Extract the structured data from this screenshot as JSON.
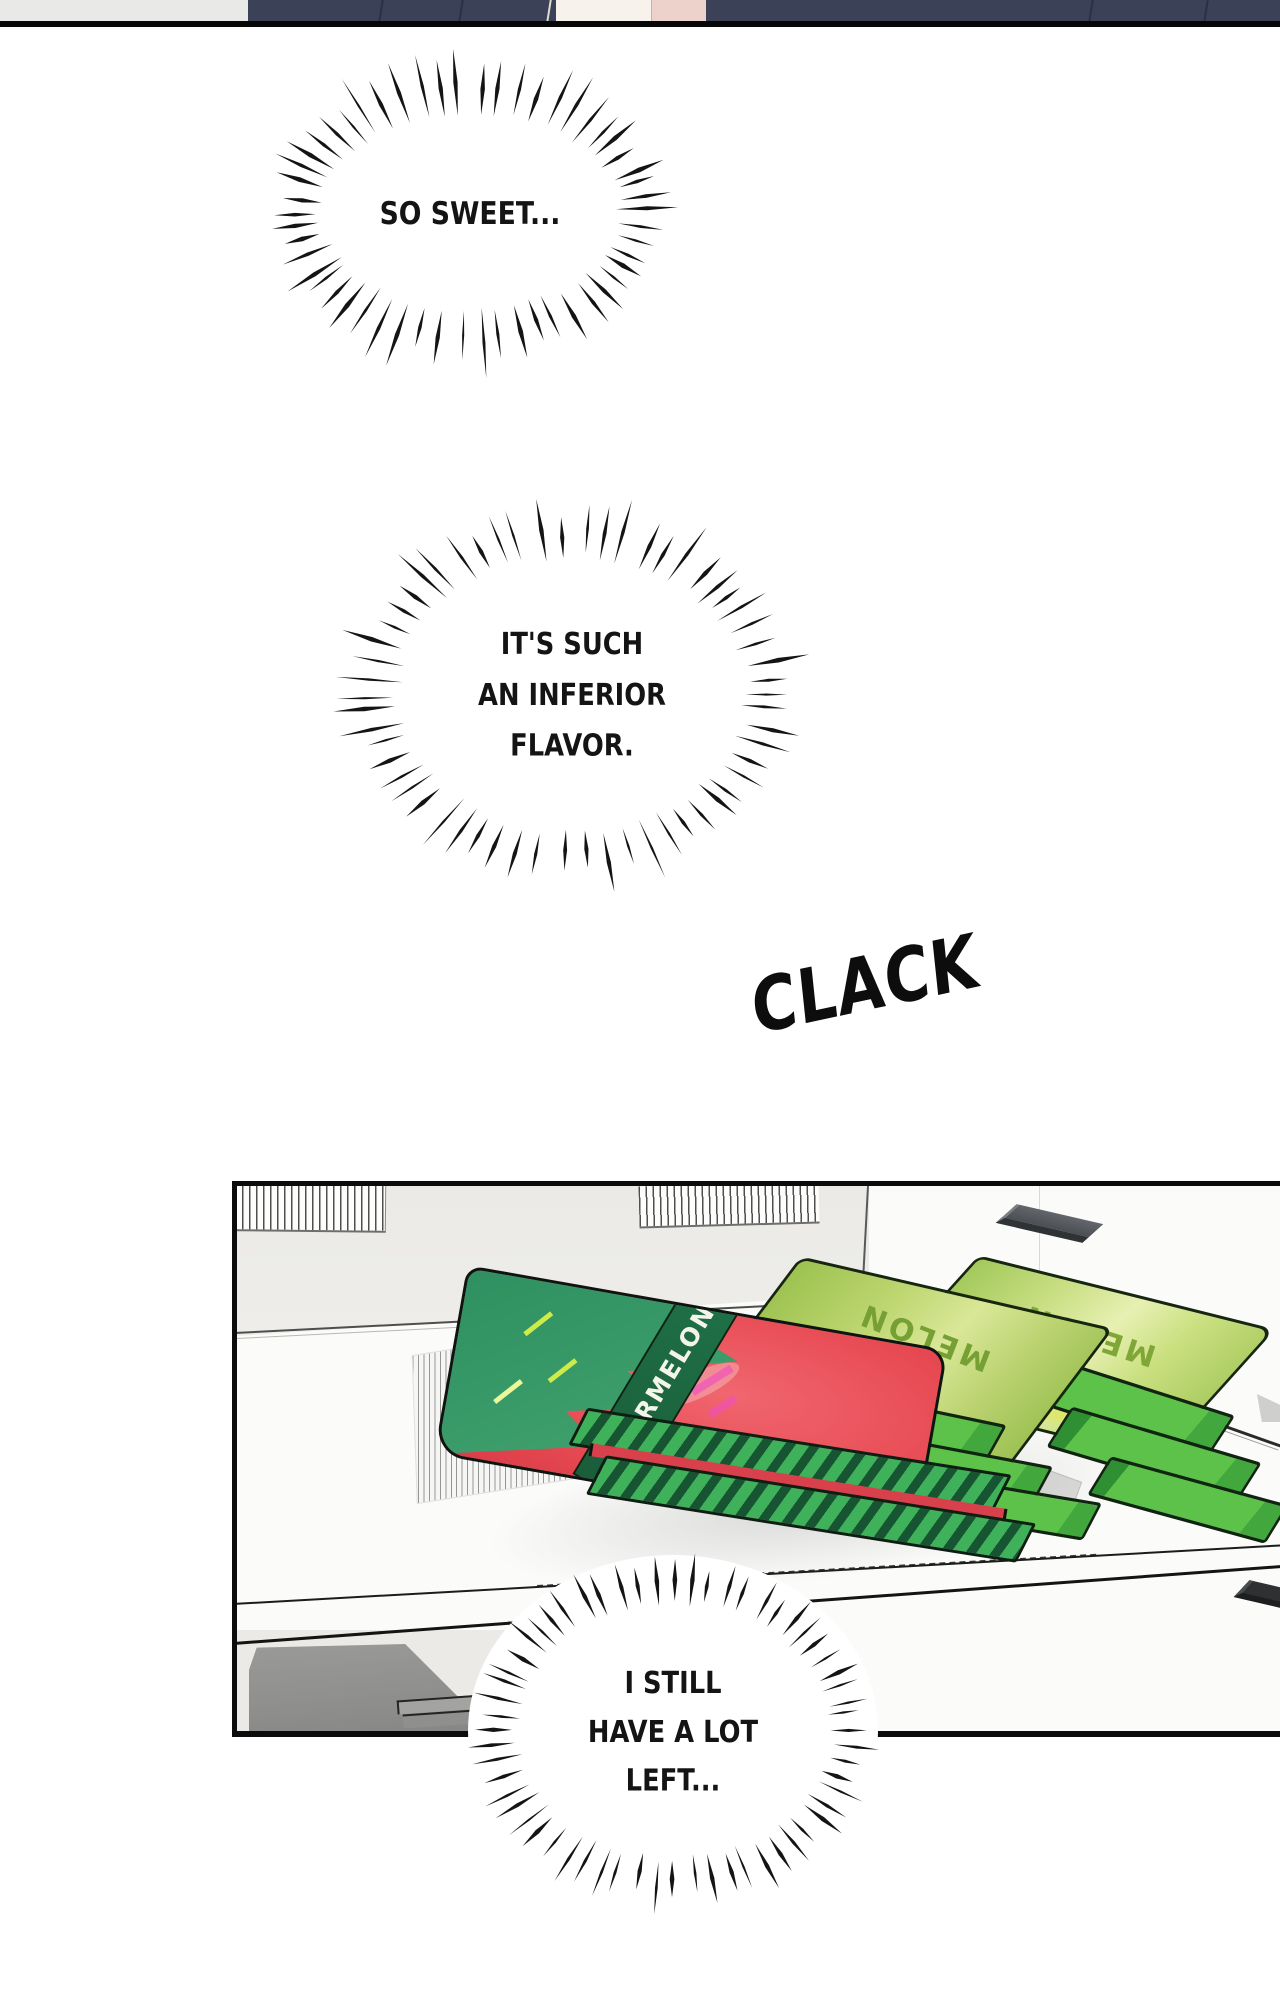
{
  "bubbles": [
    {
      "lines": [
        "SO SWEET..."
      ]
    },
    {
      "lines": [
        "IT'S SUCH",
        "AN INFERIOR",
        "FLAVOR."
      ]
    },
    {
      "lines": [
        "I STILL",
        "HAVE A LOT",
        "LEFT..."
      ]
    }
  ],
  "sfx": {
    "clack": "CLACK"
  },
  "packages": {
    "watermelon": "WATERMELON!",
    "melon_back": "MELON",
    "melon_front": "MELON"
  },
  "colors": {
    "panel_border": "#0c0c0c",
    "freezer_wall": "#ebeae7",
    "freezer_floor": "#fbfbfa",
    "watermelon_red": "#e84b54",
    "watermelon_rind": "#3fa06d",
    "banner_green": "#1f7046",
    "crimp_light_green": "#3fb15b",
    "crimp_dark_green": "#175431",
    "melon_pack_green": "#c8de82",
    "melon_text_green": "#7fa738",
    "tab_green": "#5cc24a",
    "handle_gray": "#4b4f53",
    "drawer_gray": "#8e8e8c",
    "shirt_navy": "#3b4156",
    "skin_pink": "#ecd2ca"
  }
}
